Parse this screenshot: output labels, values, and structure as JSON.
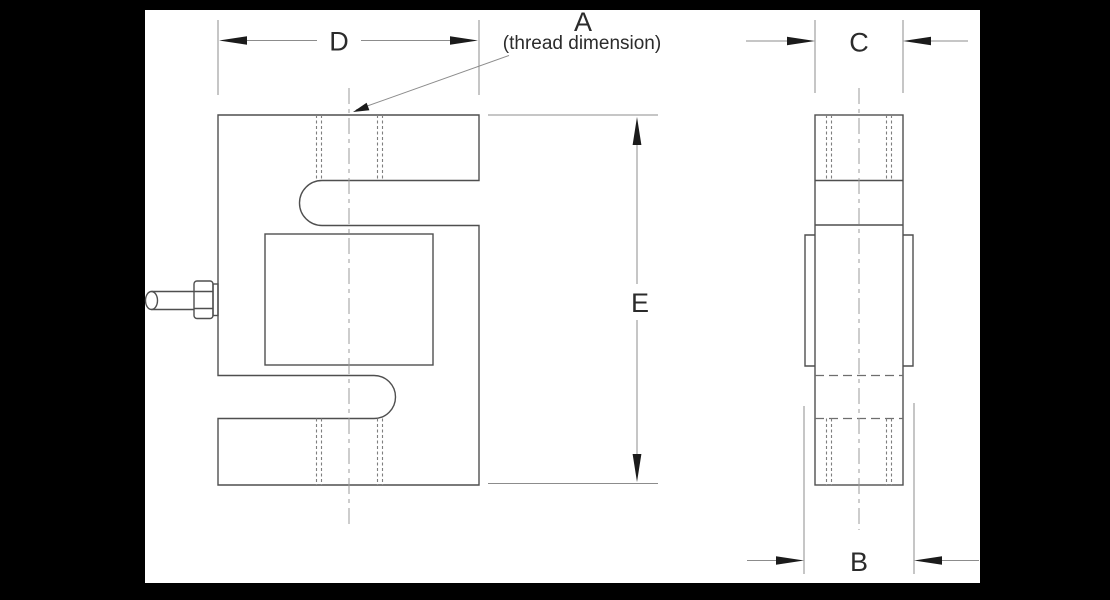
{
  "drawing": {
    "labels": {
      "A": "A",
      "A_note": "(thread dimension)",
      "B": "B",
      "C": "C",
      "D": "D",
      "E": "E"
    },
    "colors": {
      "page_background": "#000000",
      "canvas": "#ffffff",
      "outline": "#4f4f4f",
      "dimension_line": "#8c8c8c",
      "arrowhead": "#1b1b1b",
      "label_text": "#2b2b2b"
    }
  }
}
